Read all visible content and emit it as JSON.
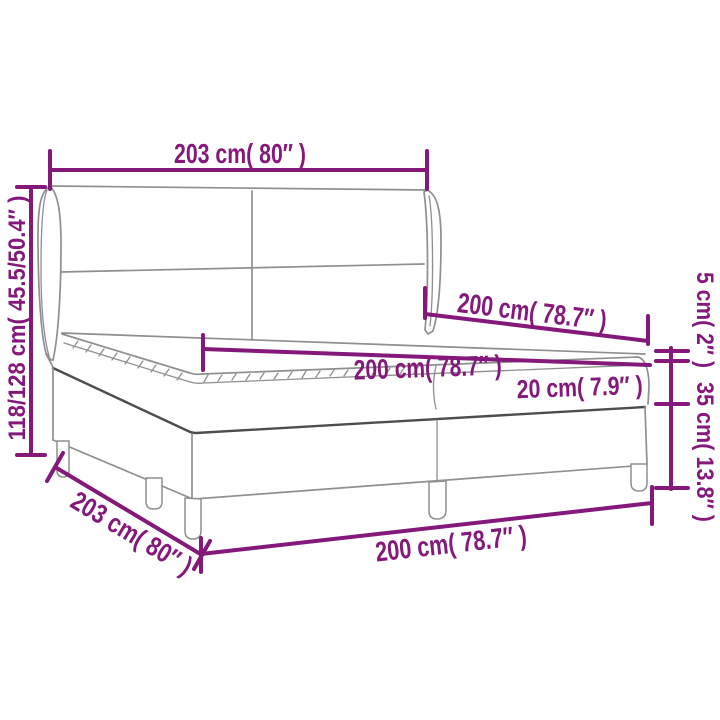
{
  "page": {
    "title": "Box spring bed dimension diagram",
    "background": "#ffffff"
  },
  "colors": {
    "dimension_accent": "#84187B",
    "outline": "#8F8F8F",
    "outline_dark": "#4D4D4D"
  },
  "labels": {
    "headboard_width_top": "203 cm( 80″ )",
    "total_height_left": "118/128 cm( 45.5/50.4″ )",
    "length_upper": "200 cm( 78.7″ )",
    "length_middle": "200 cm( 78.7″ )",
    "mattress_height": "20 cm( 7.9″ )",
    "topper_height_right": "5 cm( 2″ )",
    "base_height_right": "35 cm( 13.8″ )",
    "width_diagonal_bottom": "203 cm( 80″ )",
    "length_bottom": "200 cm( 78.7″ )"
  }
}
